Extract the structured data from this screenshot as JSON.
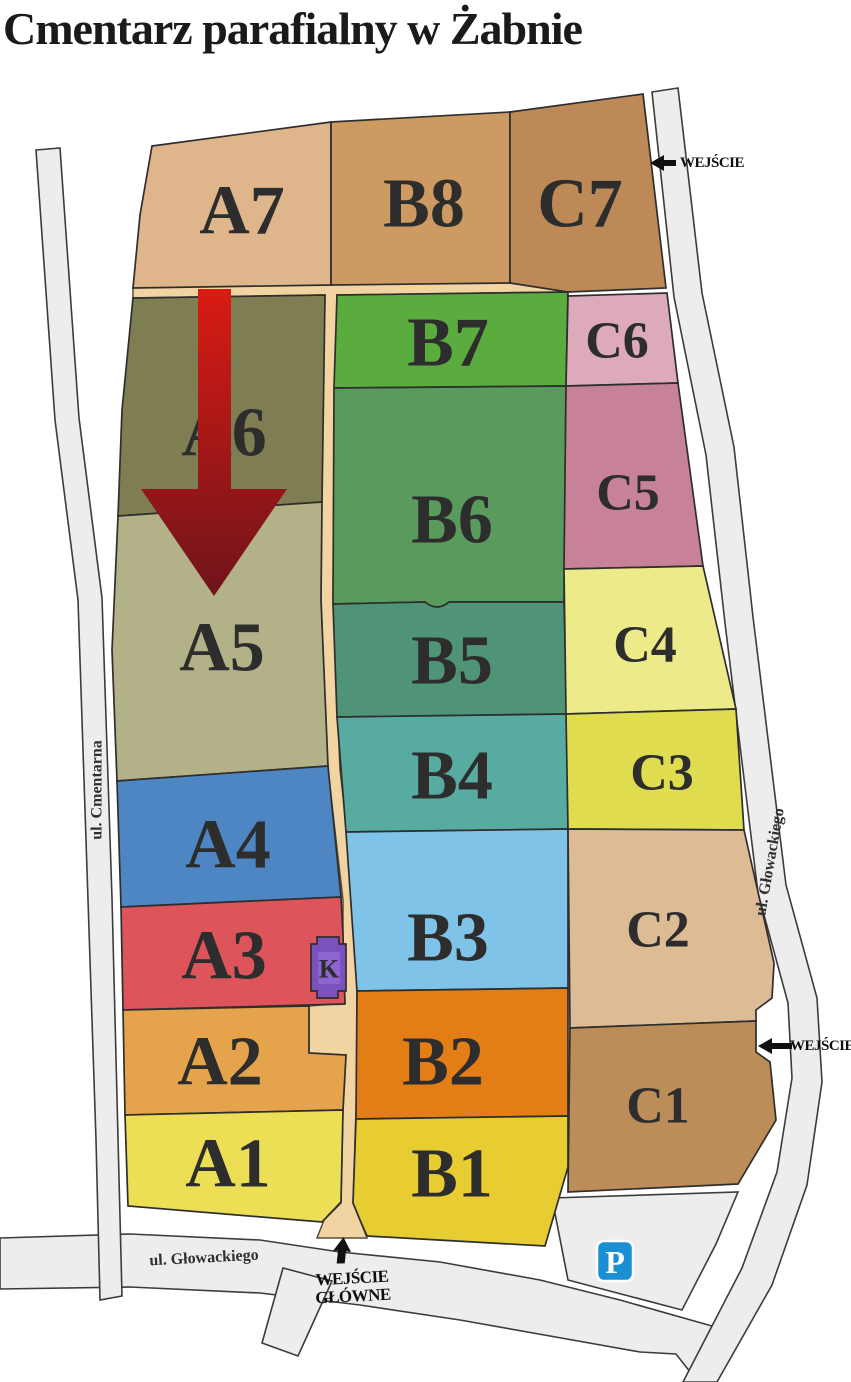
{
  "title": "Cmentarz parafialny w Żabnie",
  "colors": {
    "road": "#ededed",
    "path": "#f2d3a2",
    "label": "#2d2d2d"
  },
  "sections": {
    "A1": {
      "label": "A1",
      "color": "#ecdf55"
    },
    "A2": {
      "label": "A2",
      "color": "#e5a34c"
    },
    "A3": {
      "label": "A3",
      "color": "#dd555b"
    },
    "A4": {
      "label": "A4",
      "color": "#4e86c3"
    },
    "A5": {
      "label": "A5",
      "color": "#b3b187"
    },
    "A6": {
      "label": "A6",
      "color": "#7f7e53"
    },
    "A7": {
      "label": "A7",
      "color": "#dfb58c"
    },
    "B1": {
      "label": "B1",
      "color": "#e7cd32"
    },
    "B2": {
      "label": "B2",
      "color": "#e37d16"
    },
    "B3": {
      "label": "B3",
      "color": "#80c3e8"
    },
    "B4": {
      "label": "B4",
      "color": "#58aba0"
    },
    "B5": {
      "label": "B5",
      "color": "#509478"
    },
    "B6": {
      "label": "B6",
      "color": "#589b5d"
    },
    "B7": {
      "label": "B7",
      "color": "#5aac3e"
    },
    "B8": {
      "label": "B8",
      "color": "#cd9a62"
    },
    "C1": {
      "label": "C1",
      "color": "#bd8d59"
    },
    "C2": {
      "label": "C2",
      "color": "#ddbb94"
    },
    "C3": {
      "label": "C3",
      "color": "#dfdc4f"
    },
    "C4": {
      "label": "C4",
      "color": "#edea8a"
    },
    "C5": {
      "label": "C5",
      "color": "#c78298"
    },
    "C6": {
      "label": "C6",
      "color": "#dcaabb"
    },
    "C7": {
      "label": "C7",
      "color": "#bd8a57"
    }
  },
  "building_k": {
    "label": "K",
    "color": "#7b52bd",
    "inner_color": "#8d64d2",
    "text_color": "#20205a"
  },
  "arrow": {
    "top_color": "#da1b13",
    "bottom_color": "#6f141b"
  },
  "parking": {
    "label": "P",
    "color": "#1a8fd3"
  },
  "streets": {
    "left": "ul. Cmentarna",
    "right": "ul. Głowackiego",
    "bottom": "ul. Głowackiego"
  },
  "entrances": {
    "top_right": "WEJŚCIE",
    "mid_right": "WEJŚCIE",
    "main_line1": "WEJŚCIE",
    "main_line2": "GŁÓWNE"
  }
}
